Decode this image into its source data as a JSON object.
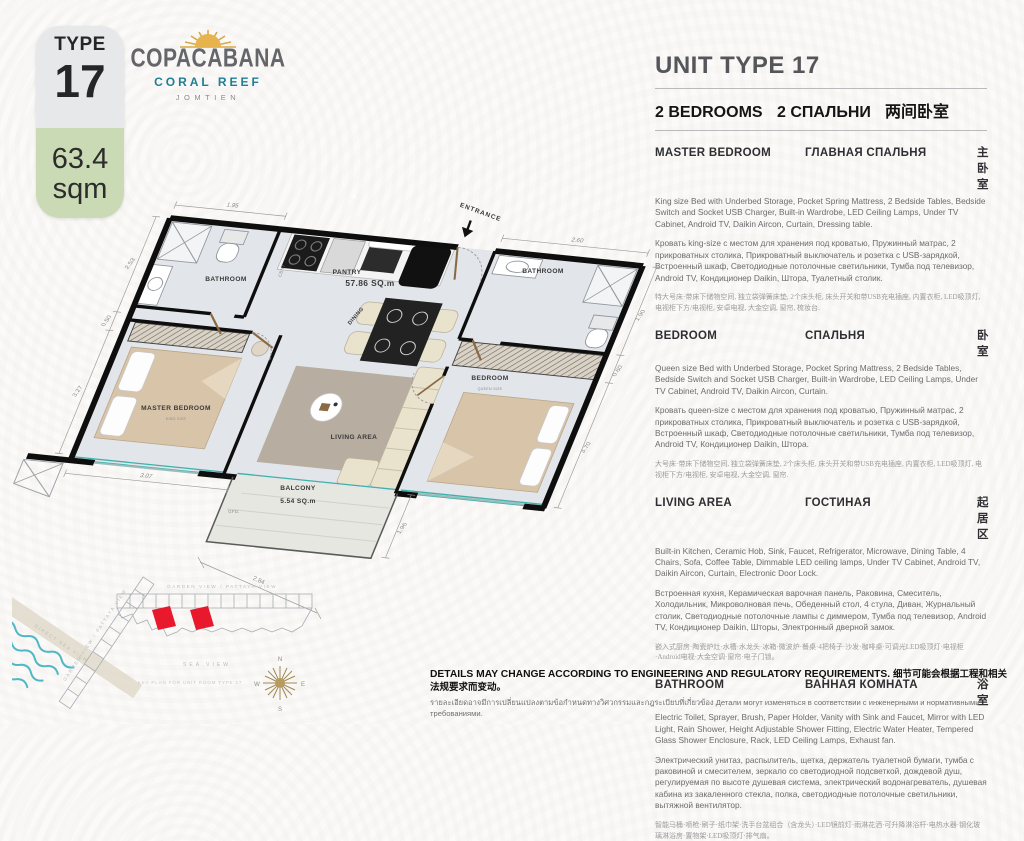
{
  "badge": {
    "type_label": "TYPE",
    "type_number": "17",
    "area_value": "63.4",
    "area_unit": "sqm"
  },
  "logo": {
    "name": "COPACABANA",
    "tagline": "CORAL REEF",
    "location": "JOMTIEN"
  },
  "header": {
    "title": "UNIT TYPE 17",
    "bedrooms_en": "2 BEDROOMS",
    "bedrooms_ru": "2 СПАЛЬНИ",
    "bedrooms_zh": "两间卧室"
  },
  "sections": [
    {
      "heading_en": "MASTER BEDROOM",
      "heading_ru": "ГЛАВНАЯ СПАЛЬНЯ",
      "heading_zh": "主卧室",
      "body_en": "King size Bed with Underbed Storage, Pocket Spring Mattress, 2 Bedside Tables, Bedside Switch and Socket USB Charger, Built-in Wardrobe, LED Ceiling Lamps, Under TV Cabinet, Android TV, Daikin Aircon, Curtain, Dressing table.",
      "body_ru": "Кровать king-size с местом для хранения под кроватью, Пружинный матрас, 2 прикроватных столика, Прикроватный выключатель и розетка с USB-зарядкой, Встроенный шкаф, Светодиодные потолочные светильники, Тумба под телевизор, Android TV, Кондиционер Daikin, Штора, Туалетный столик.",
      "body_zh": "特大号床·带床下储物空间, 独立袋弹簧床垫, 2个床头柜, 床头开关和带USB充电插座, 内置衣柜, LED吸顶灯, 电视柜下方/电视柜, 安卓电视, 大金空调, 窗帘, 梳妆台."
    },
    {
      "heading_en": "BEDROOM",
      "heading_ru": "СПАЛЬНЯ",
      "heading_zh": "卧室",
      "body_en": "Queen size Bed with Underbed Storage, Pocket Spring Mattress, 2 Bedside Tables, Bedside Switch and Socket USB Charger, Built-in Wardrobe, LED Ceiling Lamps, Under TV Cabinet, Android TV, Daikin Aircon, Curtain.",
      "body_ru": "Кровать queen-size с местом для хранения под кроватью, Пружинный матрас, 2 прикроватных столика, Прикроватный выключатель и розетка с USB-зарядкой, Встроенный шкаф, Светодиодные потолочные светильники, Тумба под телевизор, Android TV, Кондиционер Daikin, Штора.",
      "body_zh": "大号床·带床下储物空间, 独立袋弹簧床垫, 2个床头柜, 床头开关和带USB充电插座, 内置衣柜, LED吸顶灯, 电视柜下方/电视柜, 安卓电视, 大金空调, 窗帘."
    },
    {
      "heading_en": "LIVING AREA",
      "heading_ru": "ГОСТИНАЯ",
      "heading_zh": "起居区",
      "body_en": "Built-in Kitchen, Ceramic Hob, Sink, Faucet, Refrigerator, Microwave, Dining Table, 4 Chairs, Sofa, Coffee Table, Dimmable LED ceiling lamps, Under TV Cabinet, Android TV, Daikin Aircon, Curtain, Electronic Door Lock.",
      "body_ru": "Встроенная кухня, Керамическая варочная панель, Раковина, Смеситель, Холодильник, Микроволновая печь, Обеденный стол, 4 стула, Диван, Журнальный столик, Светодиодные потолочные лампы с диммером, Тумба под телевизор, Android TV, Кондиционер Daikin, Шторы, Электронный дверной замок.",
      "body_zh": "嵌入式厨房·陶瓷炉灶·水槽·水龙头·冰箱·微波炉·餐桌·4把椅子·沙发·咖啡桌·可调光LED吸顶灯·电视柜·Android电视·大金空调·窗帘·电子门锁。"
    },
    {
      "heading_en": "BATHROOM",
      "heading_ru": "ВАННАЯ КОМНАТА",
      "heading_zh": "浴室",
      "body_en": "Electric Toilet, Sprayer, Brush, Paper Holder, Vanity with Sink and Faucet, Mirror with LED Light, Rain Shower, Height Adjustable Shower Fitting, Electric Water Heater, Tempered Glass Shower Enclosure, Rack, LED Ceiling Lamps, Exhaust fan.",
      "body_ru": "Электрический унитаз, распылитель, щетка, держатель туалетной бумаги, тумба с раковиной и смесителем, зеркало со светодиодной подсветкой, дождевой душ, регулируемая по высоте душевая система, электрический водонагреватель, душевая кабина из закаленного стекла, полка, светодиодные потолочные светильники, вытяжной вентилятор.",
      "body_zh": "智能马桶·喷枪·刷子·纸巾架·洗手台盆组合（含龙头）·LED镜前灯·雨淋花洒·可升降淋浴杆·电热水器·钢化玻璃淋浴房·置物架·LED吸顶灯·排气扇。"
    }
  ],
  "floorplan": {
    "total_area": "57.86 SQ.m",
    "labels": {
      "bathroom1": "BATHROOM",
      "bathroom2": "BATHROOM",
      "pantry": "PANTRY",
      "entrance": "ENTRANCE",
      "master_bedroom": "MASTER BEDROOM",
      "king_size": "KING SIZE",
      "living_area": "LIVING AREA",
      "dining": "DINING",
      "bedroom": "BEDROOM",
      "queen_size": "QUEEN SIZE",
      "balcony": "BALCONY",
      "balcony_area": "5.54 SQ.m",
      "cabinet": "CBNT",
      "gfd": "GFD.",
      "washer": "W",
      "fridge": "F"
    },
    "dimensions": {
      "bathroom1_width": "1.95",
      "upper_left": "2.53",
      "left_small": "0.50",
      "left_wall": "3.27",
      "bottom_left": "3.07",
      "bottom_outer": "2.84",
      "bathroom2_width": "2.60",
      "right_top": "1.90",
      "right_mid": "0.60",
      "right_wall": "3.70",
      "balcony_side": "1.96"
    }
  },
  "keyplan": {
    "garden_view_diag": "GARDEN VIEW / PATTAYA VIEW",
    "garden_view": "GARDEN VIEW / PATTAYA VIEW",
    "direct_sea_view": "DIRECT SEA VIEW",
    "sea_view": "SEA VIEW",
    "caption": "KEY PLAN FOR UNIT ROOM TYPE 17",
    "compass_n": "N",
    "compass_e": "E",
    "compass_s": "S",
    "compass_w": "W"
  },
  "disclaimer": {
    "en": "DETAILS MAY CHANGE ACCORDING TO ENGINEERING AND REGULATORY REQUIREMENTS.",
    "zh": "细节可能会根据工程和相关法规要求而变动。",
    "th": "รายละเอียดอาจมีการเปลี่ยนแปลงตามข้อกำหนดทางวิศวกรรมและกฎระเบียบที่เกี่ยวข้อง",
    "ru": "Детали могут изменяться в соответствии с инженерными и нормативными требованиями."
  },
  "colors": {
    "accent_teal": "#1f7f94",
    "logo_gold": "#d9a845",
    "badge_green": "#c9dab4",
    "keyplan_red": "#e8192c"
  }
}
